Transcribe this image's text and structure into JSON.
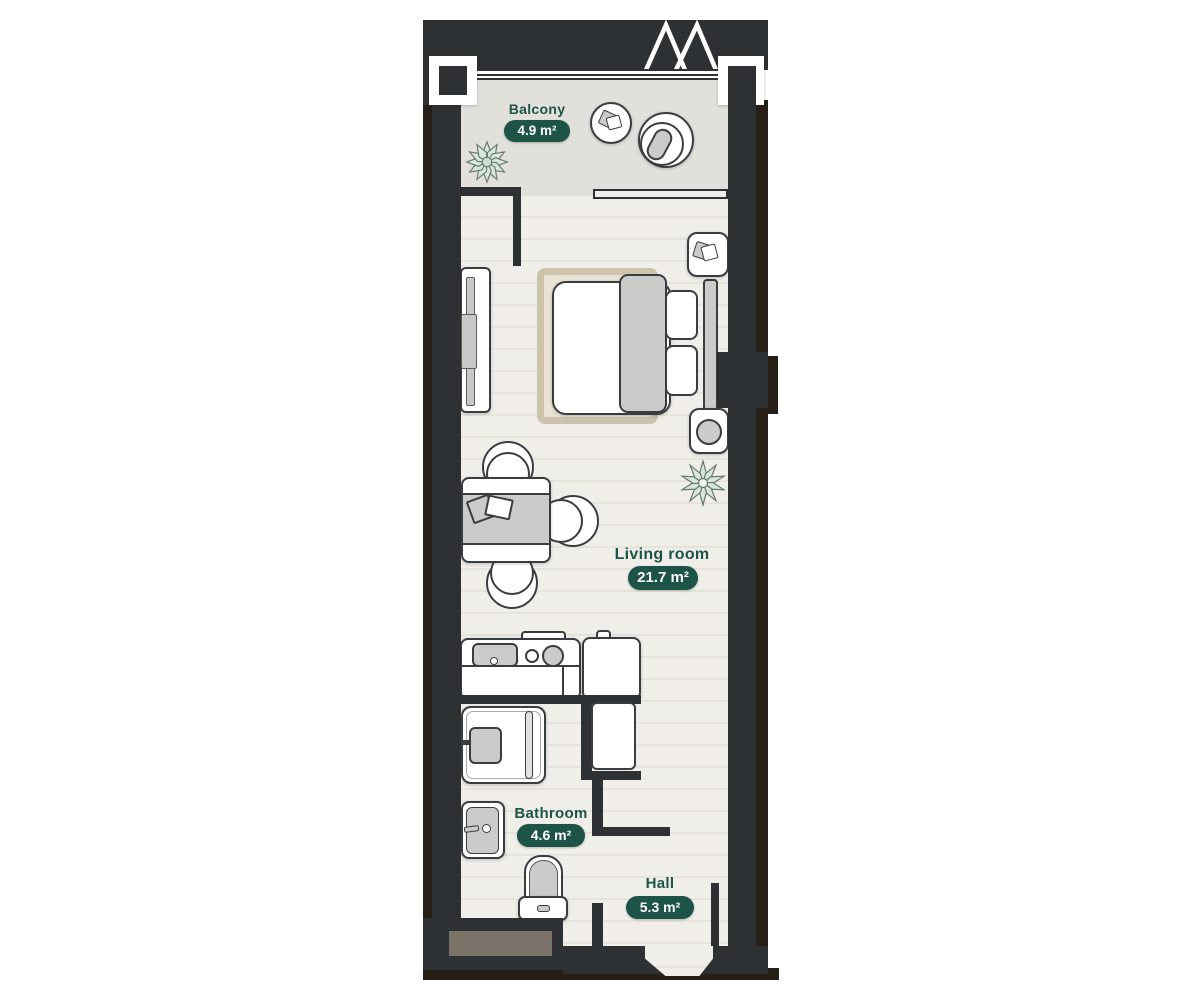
{
  "rooms": {
    "balcony": {
      "label": "Balcony",
      "area": "4.9 m²"
    },
    "living_room": {
      "label": "Living room",
      "area": "21.7 m²"
    },
    "bathroom": {
      "label": "Bathroom",
      "area": "4.6 m²"
    },
    "hall": {
      "label": "Hall",
      "area": "5.3 m²"
    }
  },
  "colors": {
    "accent_green": "#1d5447",
    "badge_text": "#ffffff",
    "wall": "#2e3133",
    "wall_shadow": "#271f15",
    "floor": "#f0eee9",
    "floor_stripe": "#e6e3db",
    "balcony_floor": "#e2e0da",
    "furniture_gray": "#cbcbc9",
    "rug_fill": "#eae3d5",
    "rug_border": "#cdc2ac",
    "shaft_brown": "#7b7268",
    "plant_green": "#d7e7dd"
  }
}
